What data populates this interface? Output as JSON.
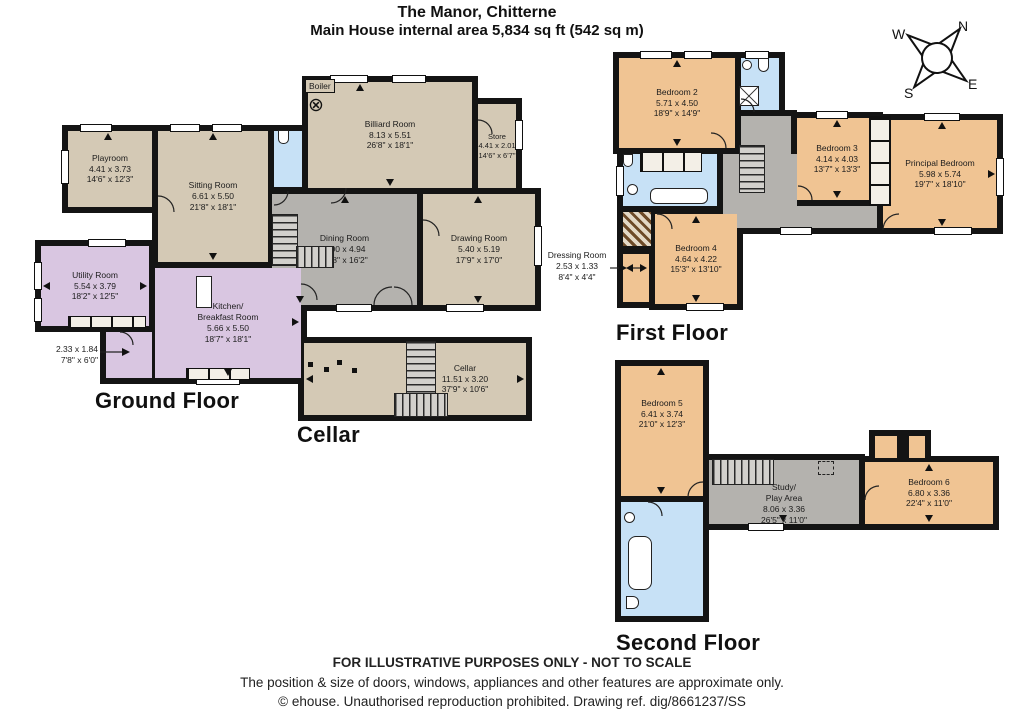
{
  "title": {
    "line1": "The Manor, Chitterne",
    "line2": "Main House internal area 5,834 sq ft (542 sq m)"
  },
  "compass": {
    "north": "N",
    "east": "E",
    "south": "S",
    "west": "W"
  },
  "floors": {
    "ground": {
      "label": "Ground Floor",
      "rooms": {
        "playroom": {
          "name": "Playroom",
          "metric": "4.41 x 3.73",
          "imperial": "14'6\" x 12'3\""
        },
        "sitting_room": {
          "name": "Sitting Room",
          "metric": "6.61 x 5.50",
          "imperial": "21'8\" x 18'1\""
        },
        "billiard_room": {
          "name": "Billiard Room",
          "metric": "8.13 x 5.51",
          "imperial": "26'8\" x 18'1\""
        },
        "store": {
          "name": "Store",
          "metric": "4.41 x 2.01",
          "imperial": "14'6\" x 6'7\""
        },
        "dining_room": {
          "name": "Dining Room",
          "metric": "6.00 x 4.94",
          "imperial": "19'8\" x 16'2\""
        },
        "drawing_room": {
          "name": "Drawing Room",
          "metric": "5.40 x 5.19",
          "imperial": "17'9\" x 17'0\""
        },
        "utility_room": {
          "name": "Utility Room",
          "metric": "5.54 x 3.79",
          "imperial": "18'2\" x 12'5\""
        },
        "kitchen": {
          "name": "Kitchen/\nBreakfast Room",
          "metric": "5.66 x 5.50",
          "imperial": "18'7\" x 18'1\""
        },
        "lobby": {
          "metric": "2.33 x 1.84",
          "imperial": "7'8\" x 6'0\""
        },
        "boiler": {
          "label": "Boiler",
          "symbol": "⊗"
        }
      }
    },
    "cellar": {
      "label": "Cellar",
      "rooms": {
        "cellar": {
          "name": "Cellar",
          "metric": "11.51 x 3.20",
          "imperial": "37'9\" x 10'6\""
        }
      }
    },
    "first": {
      "label": "First Floor",
      "rooms": {
        "bedroom2": {
          "name": "Bedroom 2",
          "metric": "5.71 x 4.50",
          "imperial": "18'9\" x 14'9\""
        },
        "bedroom3": {
          "name": "Bedroom 3",
          "metric": "4.14 x 4.03",
          "imperial": "13'7\" x 13'3\""
        },
        "principal": {
          "name": "Principal Bedroom",
          "metric": "5.98 x 5.74",
          "imperial": "19'7\" x 18'10\""
        },
        "bedroom4": {
          "name": "Bedroom 4",
          "metric": "4.64 x 4.22",
          "imperial": "15'3\" x 13'10\""
        },
        "dressing": {
          "name": "Dressing Room",
          "metric": "2.53 x 1.33",
          "imperial": "8'4\" x 4'4\""
        }
      }
    },
    "second": {
      "label": "Second Floor",
      "rooms": {
        "bedroom5": {
          "name": "Bedroom 5",
          "metric": "6.41 x 3.74",
          "imperial": "21'0\" x 12'3\""
        },
        "study": {
          "name": "Study/\nPlay Area",
          "metric": "8.06 x 3.36",
          "imperial": "26'5\" x 11'0\""
        },
        "bedroom6": {
          "name": "Bedroom 6",
          "metric": "6.80 x 3.36",
          "imperial": "22'4\" x 11'0\""
        }
      }
    }
  },
  "footer": {
    "line1": "FOR ILLUSTRATIVE PURPOSES ONLY - NOT TO SCALE",
    "line2": "The position & size of doors, windows, appliances and other features are approximate only.",
    "line3": "© ehouse. Unauthorised reproduction prohibited. Drawing ref. dig/8661237/SS"
  },
  "colors": {
    "wall": "#141414",
    "reception": "#d4c9b5",
    "bedroom": "#f0c493",
    "kitchen_utility": "#d9c6e1",
    "bathroom": "#c7e1f6",
    "hall": "#b4b2ae"
  }
}
